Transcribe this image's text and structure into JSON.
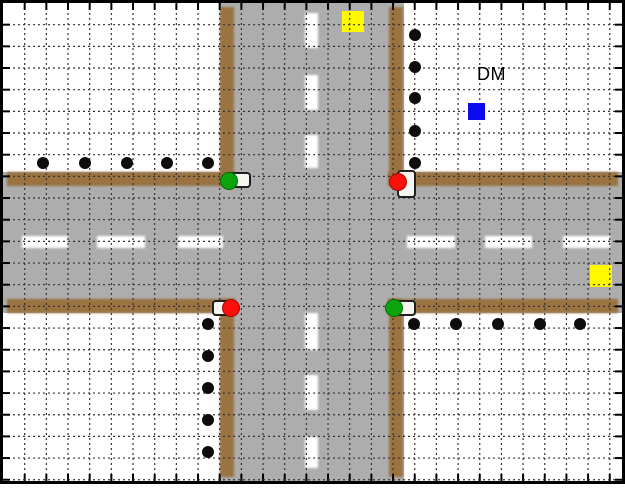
{
  "view": {
    "title": "traffic-intersection-simulation-world",
    "dm_label": "DM"
  },
  "colors": {
    "background": "#ffffff",
    "border": "#000000",
    "road": "#aeadad",
    "curb": "#9a7340",
    "lane": "#ffffff",
    "grid": "#333333",
    "tick": "#000000",
    "pedestrian": "#0d0d0d",
    "red": "#fb100c",
    "green": "#0ca30c",
    "yellow": "#fef900",
    "blue": "#0b0bee"
  },
  "world": {
    "inner_width": 619,
    "inner_height": 478,
    "grid": {
      "spacing": 21.67,
      "cols": 28,
      "rows": 22,
      "tick_length": 7,
      "dash": "2 3"
    },
    "roads": {
      "surfaces": [
        [
          217,
          0,
          184,
          478
        ],
        [
          0,
          169,
          619,
          141
        ]
      ],
      "curbs": [
        [
          4,
          169,
          228,
          14
        ],
        [
          385,
          169,
          230,
          14
        ],
        [
          4,
          296,
          228,
          14
        ],
        [
          385,
          296,
          230,
          14
        ],
        [
          217,
          4,
          14,
          179
        ],
        [
          386,
          4,
          14,
          179
        ],
        [
          217,
          296,
          14,
          178
        ],
        [
          386,
          296,
          14,
          178
        ]
      ],
      "lane_dashes_h": [
        [
          19,
          233,
          46,
          12
        ],
        [
          94,
          233,
          48,
          12
        ],
        [
          175,
          233,
          45,
          12
        ],
        [
          404,
          233,
          48,
          12
        ],
        [
          482,
          233,
          47,
          12
        ],
        [
          560,
          233,
          47,
          12
        ]
      ],
      "lane_dashes_v": [
        [
          302,
          10,
          13,
          35
        ],
        [
          302,
          72,
          13,
          35
        ],
        [
          302,
          132,
          13,
          33
        ],
        [
          302,
          310,
          13,
          37
        ],
        [
          302,
          372,
          13,
          35
        ],
        [
          302,
          434,
          13,
          31
        ]
      ]
    },
    "patch_markers": [
      [
        339,
        8,
        22,
        21
      ],
      [
        587,
        262,
        22,
        22
      ]
    ],
    "pedestrians": {
      "radius": 6.4,
      "points": [
        [
          40,
          160
        ],
        [
          82,
          160
        ],
        [
          124,
          160
        ],
        [
          164,
          160
        ],
        [
          205,
          160
        ],
        [
          412,
          32
        ],
        [
          412,
          64
        ],
        [
          412,
          95
        ],
        [
          412,
          128
        ],
        [
          412,
          160
        ],
        [
          205,
          321
        ],
        [
          205,
          353
        ],
        [
          205,
          385
        ],
        [
          205,
          417
        ],
        [
          205,
          449
        ],
        [
          411,
          321
        ],
        [
          453,
          321
        ],
        [
          495,
          321
        ],
        [
          537,
          321
        ],
        [
          577,
          321
        ]
      ]
    },
    "light_radius": 9,
    "traffic_lights": [
      {
        "corner": "nw",
        "state": "green",
        "housing": [
          224,
          169,
          24,
          16
        ],
        "center": [
          226,
          178
        ]
      },
      {
        "corner": "ne",
        "state": "red",
        "housing": [
          394,
          167,
          19,
          28
        ],
        "center": [
          395,
          179
        ]
      },
      {
        "corner": "sw",
        "state": "red",
        "housing": [
          209,
          297,
          24,
          16
        ],
        "center": [
          228,
          305
        ]
      },
      {
        "corner": "se",
        "state": "green",
        "housing": [
          393,
          297,
          20,
          16
        ],
        "center": [
          391,
          305
        ]
      }
    ],
    "dm_marker": {
      "rect": [
        465,
        100,
        17,
        17
      ]
    }
  }
}
